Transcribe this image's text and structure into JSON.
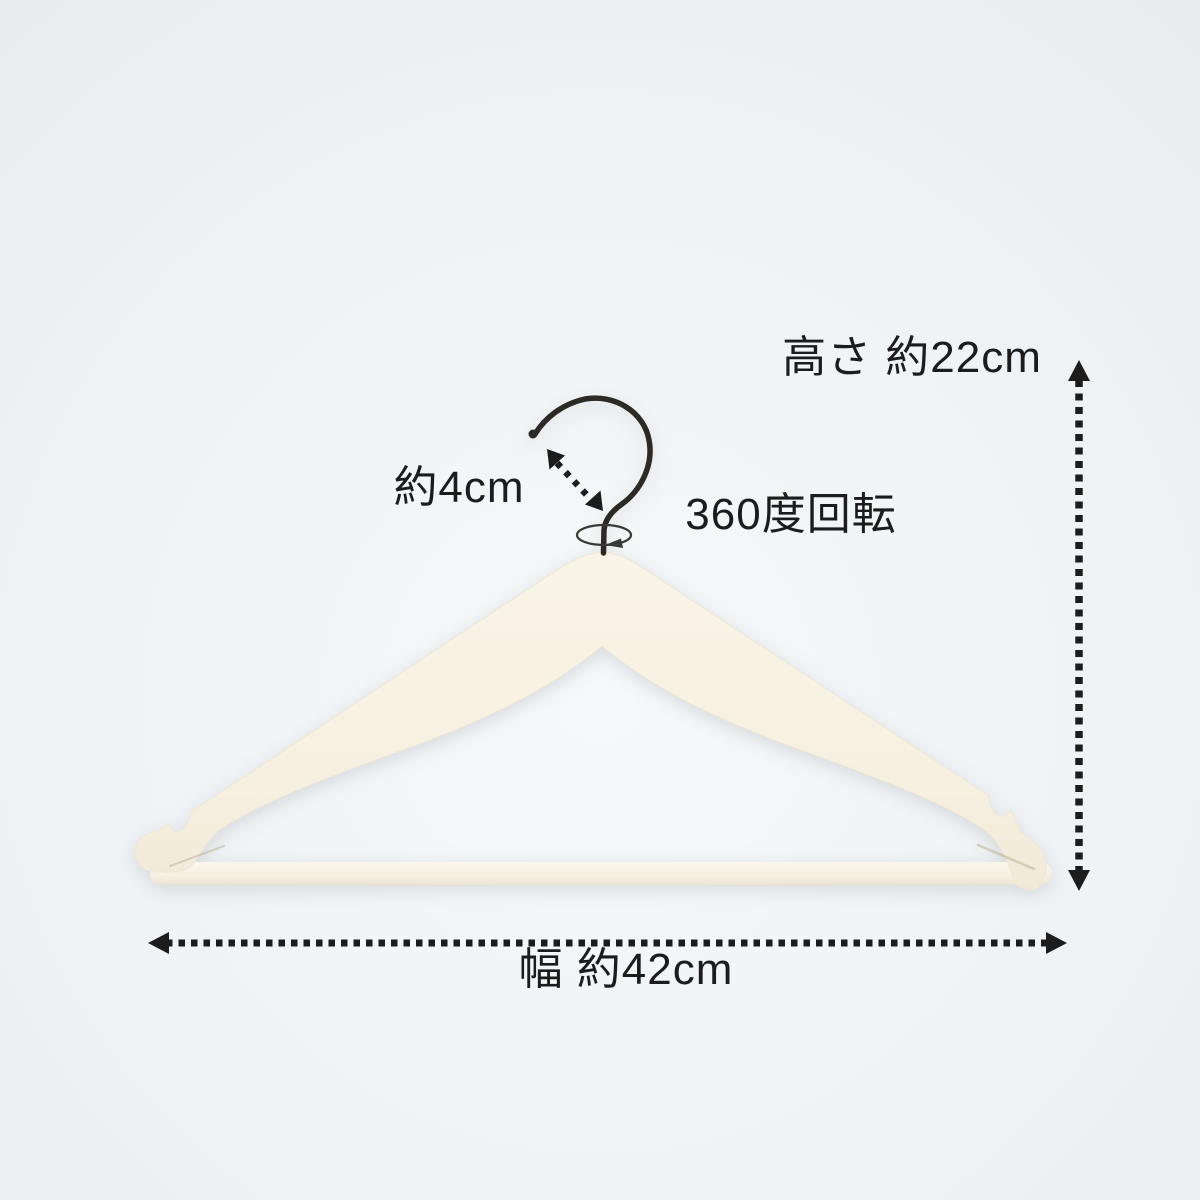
{
  "scene": {
    "background_color": "#edf0f2",
    "background_highlight": "#f7f9fa"
  },
  "product": {
    "name": "wooden-hanger",
    "body_color": "#f7f1e3",
    "bar_color": "#f8f4ea",
    "hook_color": "#2d2a26"
  },
  "labels": {
    "height": "高さ 約22cm",
    "hook_length": "約4cm",
    "rotation": "360度回転",
    "width": "幅 約42cm"
  },
  "annotation": {
    "color": "#1c1c1c",
    "font_size_px": 44
  }
}
